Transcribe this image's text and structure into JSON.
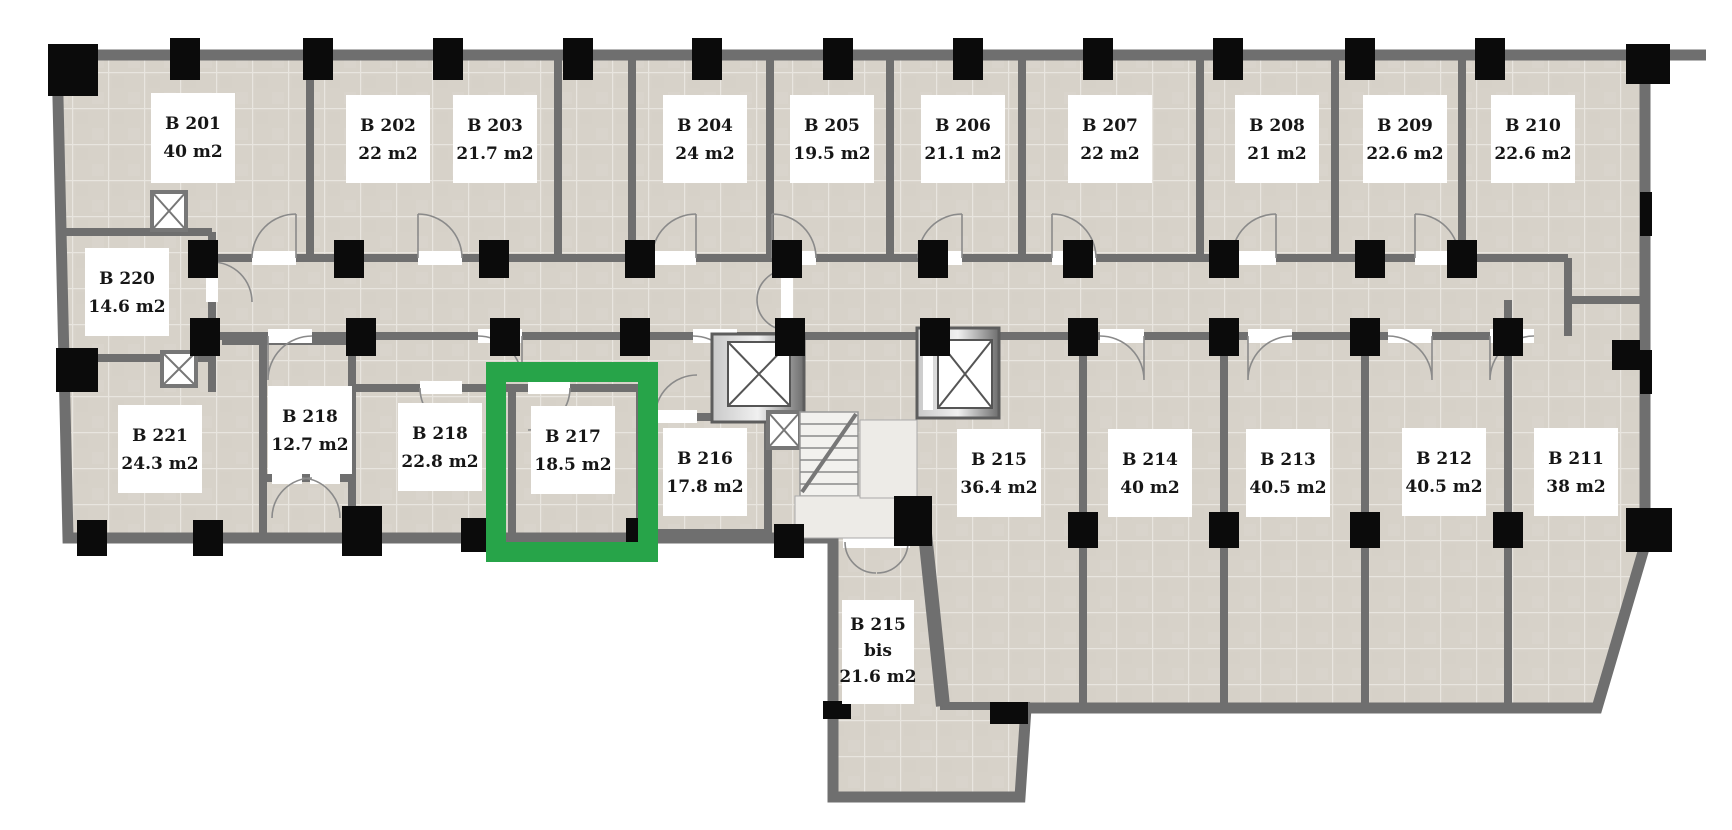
{
  "plan": {
    "selected_room": "B 217",
    "colors": {
      "highlight_green": "#27a449",
      "wall_gray": "#6f6f6f",
      "floor_tile": "#d7d2c9",
      "tile_grout": "#e8e5df",
      "column_black": "#0b0b0b",
      "label_background": "#ffffff",
      "label_text": "#161616"
    },
    "rooms": [
      {
        "label": "B 201",
        "area": "40 m2",
        "highlighted": false
      },
      {
        "label": "B 202",
        "area": "22 m2",
        "highlighted": false
      },
      {
        "label": "B 203",
        "area": "21.7 m2",
        "highlighted": false
      },
      {
        "label": "B 204",
        "area": "24 m2",
        "highlighted": false
      },
      {
        "label": "B 205",
        "area": "19.5 m2",
        "highlighted": false
      },
      {
        "label": "B 206",
        "area": "21.1 m2",
        "highlighted": false
      },
      {
        "label": "B 207",
        "area": "22 m2",
        "highlighted": false
      },
      {
        "label": "B 208",
        "area": "21 m2",
        "highlighted": false
      },
      {
        "label": "B 209",
        "area": "22.6 m2",
        "highlighted": false
      },
      {
        "label": "B 210",
        "area": "22.6 m2",
        "highlighted": false
      },
      {
        "label": "B 220",
        "area": "14.6 m2",
        "highlighted": false
      },
      {
        "label": "B 221",
        "area": "24.3 m2",
        "highlighted": false
      },
      {
        "label": "B 218",
        "area": "12.7 m2",
        "highlighted": false
      },
      {
        "label": "B 218",
        "area": "22.8 m2",
        "highlighted": false
      },
      {
        "label": "B 217",
        "area": "18.5 m2",
        "highlighted": true
      },
      {
        "label": "B 216",
        "area": "17.8 m2",
        "highlighted": false
      },
      {
        "label": "B 215",
        "area": "36.4 m2",
        "highlighted": false
      },
      {
        "label": "B 214",
        "area": "40 m2",
        "highlighted": false
      },
      {
        "label": "B 213",
        "area": "40.5 m2",
        "highlighted": false
      },
      {
        "label": "B 212",
        "area": "40.5 m2",
        "highlighted": false
      },
      {
        "label": "B 211",
        "area": "38 m2",
        "highlighted": false
      },
      {
        "label": "B 215",
        "sub": "bis",
        "area": "21.6 m2",
        "highlighted": false
      }
    ]
  }
}
